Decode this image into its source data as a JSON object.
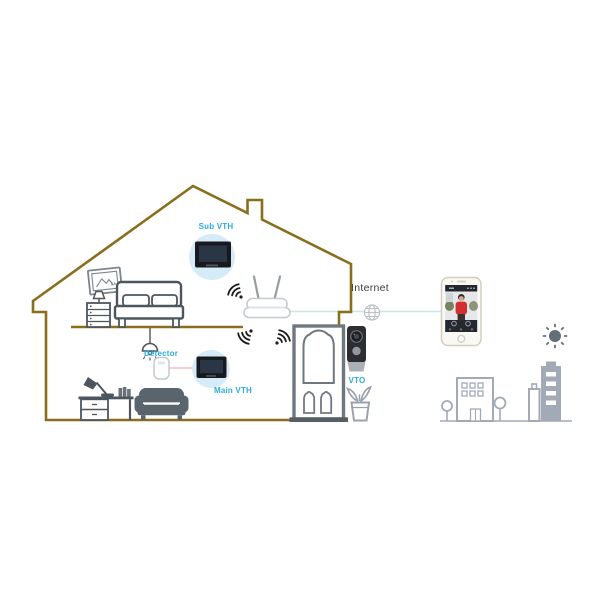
{
  "labels": {
    "sub_vth": "Sub VTH",
    "detector": "Detector",
    "main_vth": "Main VTH",
    "vto": "VTO",
    "internet": "Internet"
  },
  "devices": [
    {
      "name": "sub-vth-indoor-monitor-icon",
      "label": "Sub VTH",
      "location": "upstairs bedroom"
    },
    {
      "name": "main-vth-indoor-monitor-icon",
      "label": "Main VTH",
      "location": "downstairs living room"
    },
    {
      "name": "detector-icon",
      "label": "Detector",
      "location": "downstairs, wired to Main VTH"
    },
    {
      "name": "wifi-router-icon",
      "label": "",
      "location": "upstairs, linked to Internet"
    },
    {
      "name": "vto-door-station-icon",
      "label": "VTO",
      "location": "outside front door"
    },
    {
      "name": "smartphone-icon",
      "label": "",
      "location": "remote, via Internet"
    }
  ],
  "connections": [
    {
      "from": "wifi-router",
      "to": "smartphone",
      "via": "Internet",
      "style": "teal-line-globe"
    },
    {
      "from": "detector",
      "to": "main-vth",
      "style": "pink-line"
    },
    {
      "from": "router",
      "to": "vth/vto",
      "style": "wifi-waves"
    }
  ],
  "colors": {
    "house_outline": "#8a6e1b",
    "accent_label": "#29abe2",
    "internet_label": "#3c3c3c",
    "furniture_outline": "#4d565e",
    "door_outline": "#70787f",
    "city_outline": "#a2aab5",
    "device_halo": "#d5ebf8",
    "monitor_body": "#17191d",
    "monitor_screen": "#2a3645",
    "internet_link": "#c9e8e2",
    "detector_link": "#f2bdbd",
    "wifi_waves": "#1d1d1d",
    "person_shirt": "#d03030",
    "sun": "#646e78"
  }
}
